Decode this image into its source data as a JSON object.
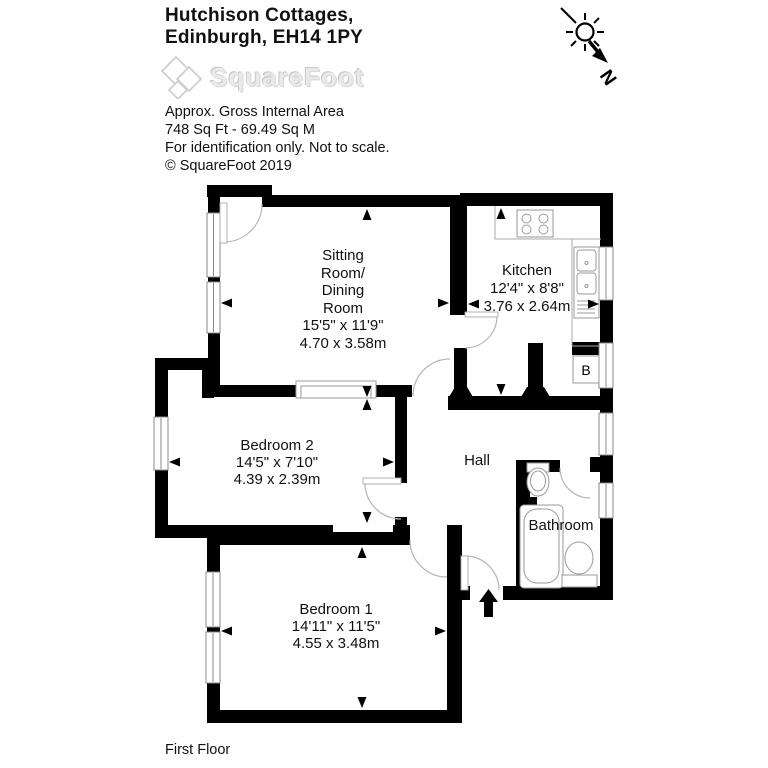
{
  "header": {
    "title_line1": "Hutchison Cottages,",
    "title_line2": "Edinburgh, EH14 1PY",
    "logo_text": "SquareFoot",
    "area_label": "Approx. Gross Internal Area",
    "area_value": "748 Sq Ft  -  69.49 Sq M",
    "disclaimer": "For identification only. Not to scale.",
    "copyright": "© SquareFoot 2019"
  },
  "compass": {
    "label": "N"
  },
  "floor": {
    "label": "First Floor"
  },
  "rooms": {
    "sitting": {
      "lines": [
        "Sitting",
        "Room/",
        "Dining",
        "Room",
        "15'5\" x 11'9\"",
        "4.70 x 3.58m"
      ]
    },
    "kitchen": {
      "lines": [
        "Kitchen",
        "12'4\" x 8'8\"",
        "3.76 x 2.64m"
      ]
    },
    "bedroom2": {
      "lines": [
        "Bedroom 2",
        "14'5\" x 7'10\"",
        "4.39 x 2.39m"
      ]
    },
    "bedroom1": {
      "lines": [
        "Bedroom 1",
        "14'11\" x 11'5\"",
        "4.55 x 3.48m"
      ]
    },
    "hall": {
      "label": "Hall"
    },
    "bathroom": {
      "label": "Bathroom"
    },
    "boiler": {
      "label": "B"
    }
  },
  "colors": {
    "wall": "#000000",
    "thin_line": "#9a9a9a",
    "text": "#111111",
    "logo_gray": "#dedede"
  }
}
